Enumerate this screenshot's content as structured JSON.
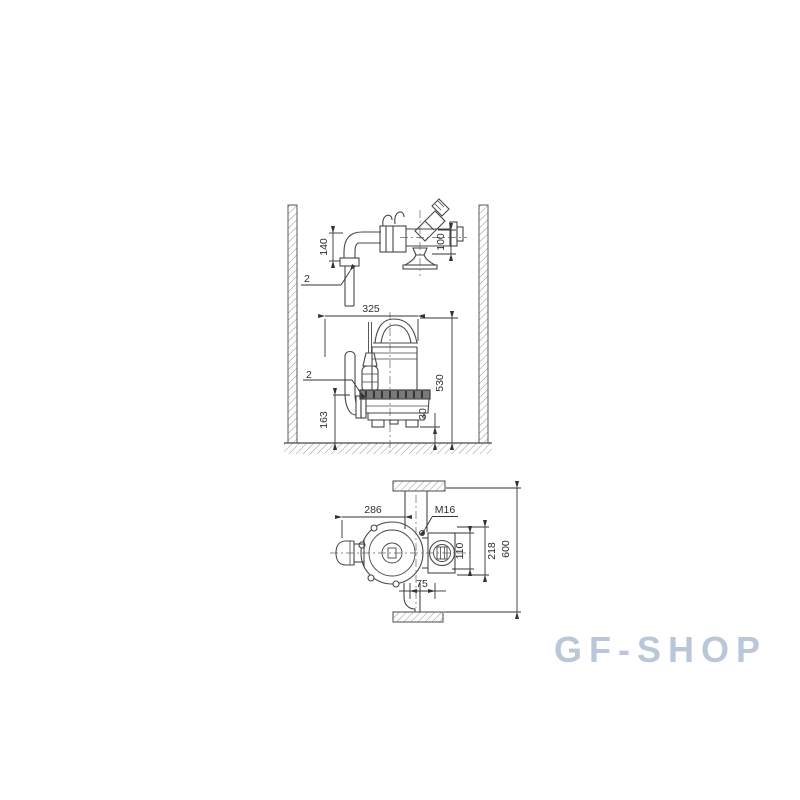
{
  "watermark": {
    "text": "GF-SHOP",
    "color": "#bac7d8"
  },
  "drawing": {
    "description": "Submersible pump dimensional / installation diagram with three views inside a hatched pit section",
    "colors": {
      "line": "#474747",
      "dimension": "#333333",
      "hatch": "#979797",
      "text": "#2e2e2e"
    },
    "pipework_view": {
      "dims": {
        "riser_height": "140",
        "valve_height": "100"
      },
      "ref_label": "2"
    },
    "side_view": {
      "dims": {
        "width": "325",
        "install_height": "530",
        "outlet_height": "163",
        "floor_clearance": "30"
      },
      "ref_label": "2"
    },
    "plan_view": {
      "dims": {
        "length": "286",
        "thread": "M16",
        "claw_width": "110",
        "body_width": "218",
        "pit_width": "600",
        "rail_offset": "75"
      }
    }
  }
}
